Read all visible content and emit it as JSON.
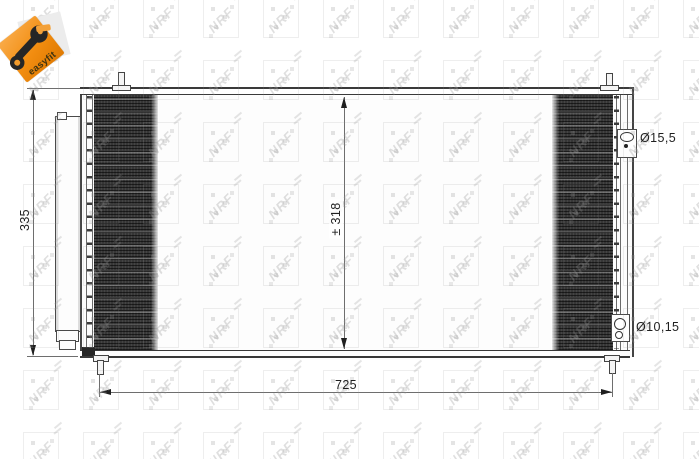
{
  "logo": {
    "label": "easyfit",
    "orange": "#f28d10"
  },
  "watermark": {
    "text": "NRF"
  },
  "diagram": {
    "labels": {
      "height_overall": "335",
      "height_core": "± 318",
      "width_overall": "725",
      "inlet_diameter": "Ø15,5",
      "outlet_diameter": "Ø10,15"
    }
  },
  "colors": {
    "line": "#3a3a3a",
    "dimension_line": "#6e6e6e",
    "core_dark": "#363636",
    "accent_orange": "#f28d10"
  }
}
